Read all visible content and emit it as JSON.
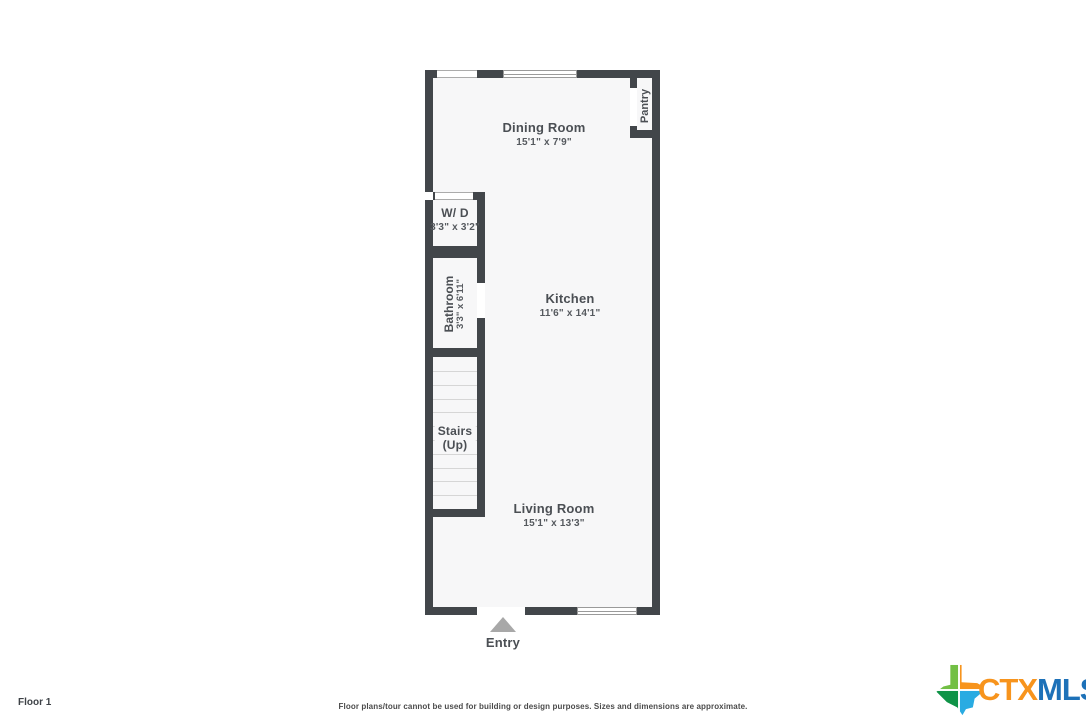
{
  "page": {
    "floor_label": "Floor 1",
    "disclaimer": "Floor plans/tour cannot be used for building or design purposes. Sizes and dimensions are approximate."
  },
  "logo": {
    "ctx": "CTX",
    "mls": "MLS",
    "ctx_color": "#F7941D",
    "mls_color": "#1D71B8",
    "texas_colors": {
      "top_left": "#72BF44",
      "top_right": "#F7941D",
      "bottom_left": "#0F9347",
      "bottom_right": "#29ABE2"
    }
  },
  "floorplan": {
    "colors": {
      "wall": "#42464A",
      "floor": "#F7F7F8",
      "stair_line": "#D6D6D6",
      "entry_arrow": "#A8A8A8",
      "label": "#4B4F54"
    },
    "stairs_tread_count": 10,
    "rooms": {
      "dining": {
        "name": "Dining Room",
        "dims": "15'1\" x 7'9\""
      },
      "pantry": {
        "name": "Pantry"
      },
      "wd": {
        "name": "W/ D",
        "dims": "3'3\" x 3'2\""
      },
      "bathroom": {
        "name": "Bathroom",
        "dims": "3'3\" x 6'11\""
      },
      "kitchen": {
        "name": "Kitchen",
        "dims": "11'6\" x 14'1\""
      },
      "stairs": {
        "name": "Stairs",
        "dims": "(Up)"
      },
      "living": {
        "name": "Living Room",
        "dims": "15'1\" x 13'3\""
      },
      "entry": {
        "name": "Entry"
      }
    }
  }
}
